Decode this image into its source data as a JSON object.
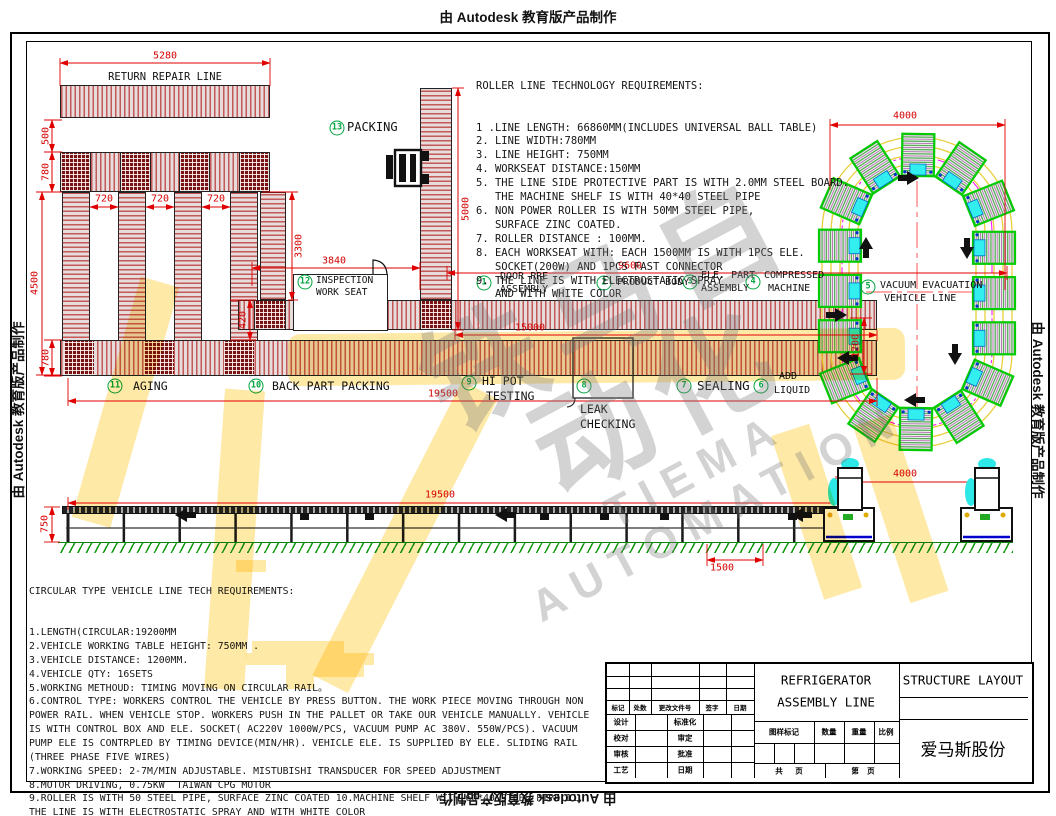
{
  "banner": {
    "autodesk_text": "由 Autodesk 教育版产品制作"
  },
  "watermark": {
    "cn": "铁马自动化",
    "en": "TIEMA AUTOMATION"
  },
  "labels": {
    "return_repair": "RETURN REPAIR LINE",
    "leak_line1": "LEAK",
    "leak_line2": "CHECKING"
  },
  "roller_req": {
    "title": "ROLLER LINE TECHNOLOGY REQUIREMENTS:",
    "lines": [
      "1 .LINE LENGTH: 66860MM(INCLUDES UNIVERSAL BALL TABLE)",
      "2. LINE WIDTH:780MM",
      "3. LINE HEIGHT: 750MM",
      "4. WORKSEAT DISTANCE:150MM",
      "5. THE LINE SIDE PROTECTIVE PART IS WITH 2.0MM STEEL BOARD.",
      "   THE MACHINE SHELF IS WITH 40*40 STEEL PIPE",
      "6. NON POWER ROLLER IS WITH 50MM STEEL PIPE,",
      "   SURFACE ZINC COATED.",
      "7. ROLLER DISTANCE : 100MM.",
      "8. EACH WORKSEAT WITH: EACH 1500MM IS WITH 1PCS ELE.",
      "   SOCKET(200W) AND 1PCS FAST CONNECTOR",
      "9. THE LINE IS WITH ELECTROSTATIC SPRAY",
      "   AND WITH WHITE COLOR"
    ]
  },
  "circular_req": {
    "title": "CIRCULAR TYPE VEHICLE LINE TECH REQUIREMENTS:",
    "lines": [
      "1.LENGTH(CIRCULAR:19200MM",
      "2.VEHICLE WORKING TABLE HEIGHT: 750MM .",
      "3.VEHICLE DISTANCE: 1200MM.",
      "4.VEHICLE QTY: 16SETS",
      "5.WORKING METHOUD: TIMING MOVING ON CIRCULAR RAIL。",
      "6.CONTROL TYPE: WORKERS CONTROL THE VEHICLE BY PRESS BUTTON. THE WORK PIECE MOVING THROUGH NON",
      "POWER RAIL. WHEN VEHICLE STOP. WORKERS PUSH IN THE PALLET OR TAKE OUR VEHICLE MANUALLY. VEHICLE",
      "IS WITH CONTROL BOX AND ELE. SOCKET( AC220V 1000W/PCS, VACUUM PUMP AC 380V. 550W/PCS). VACUUM",
      "PUMP ELE IS CONTRPLED BY TIMING DEVICE(MIN/HR). VEHICLE ELE. IS SUPPLIED BY ELE. SLIDING RAIL",
      "(THREE PHASE FIVE WIRES)",
      "7.WORKING SPEED: 2-7M/MIN ADJUSTABLE. MISTUBISHI TRANSDUCER FOR SPEED ADJUSTMENT",
      "8.MOTOR DRIVING, 0.75KW  TAIWAN CPG MOTOR",
      "9.ROLLER IS WITH 50 STEEL PIPE, SURFACE ZINC COATED 10.MACHINE SHELF WITH 60*40 STEEL PIPE 11.",
      "THE LINE IS WITH ELECTROSTATIC SPRAY AND WITH WHITE COLOR"
    ]
  },
  "stations": {
    "s1": {
      "num": "1",
      "l1": "DOOR PRE",
      "l2": "ASSEMBLY"
    },
    "s2": {
      "num": "2",
      "l1": "PRODUCT BODY",
      "l2": ""
    },
    "s3": {
      "num": "3",
      "l1": "ELE. PART",
      "l2": "ASSEMBLY"
    },
    "s4": {
      "num": "4",
      "l1": "COMPRESSED",
      "l2": "MACHINE"
    },
    "s5": {
      "num": "5",
      "l1": "VACUUM EVACUATION",
      "l2": "VEHICLE LINE"
    },
    "s6": {
      "num": "6",
      "l1": "ADD",
      "l2": "LIQUID"
    },
    "s7": {
      "num": "7",
      "l1": "SEALING",
      "l2": ""
    },
    "s8": {
      "num": "8",
      "l1": "",
      "l2": ""
    },
    "s9": {
      "num": "9",
      "l1": "HI POT",
      "l2": "TESTING"
    },
    "s10": {
      "num": "10",
      "l1": "BACK PART PACKING",
      "l2": ""
    },
    "s11": {
      "num": "11",
      "l1": "AGING",
      "l2": ""
    },
    "s12": {
      "num": "12",
      "l1": "INSPECTION",
      "l2": "WORK SEAT"
    },
    "s13": {
      "num": "13",
      "l1": "PACKING",
      "l2": ""
    }
  },
  "dims": {
    "d5280": "5280",
    "d500": "500",
    "d780_top": "780",
    "d720_1": "720",
    "d720_2": "720",
    "d720_3": "720",
    "d4500": "4500",
    "d3300": "3300",
    "d420": "420",
    "d780_bottom": "780",
    "d3840": "3840",
    "d5000": "5000",
    "d9600": "9600",
    "d15000": "15000",
    "d19500_plan": "19500",
    "d4000_oval": "4000",
    "d1200": "1200",
    "d19500_elev": "19500",
    "d750": "750",
    "d1500": "1500",
    "d4000_elev": "4000"
  },
  "vehicle_line": {
    "vehicle_count": 16
  },
  "title_block": {
    "product_line1": "REFRIGERATOR",
    "product_line2": "ASSEMBLY LINE",
    "doc_title": "STRUCTURE LAYOUT",
    "company": "爱马斯股份",
    "rev_header": [
      "标记",
      "处数",
      "更改文件号",
      "签字",
      "日期"
    ],
    "roles": [
      [
        "设计",
        "标准化"
      ],
      [
        "校对",
        "审定"
      ],
      [
        "审核",
        "批准"
      ],
      [
        "工艺",
        "日期"
      ]
    ],
    "mid_header": [
      "图样标记",
      "数量",
      "重量",
      "比例"
    ],
    "pages_left": "共      页",
    "pages_right": "第    页"
  }
}
